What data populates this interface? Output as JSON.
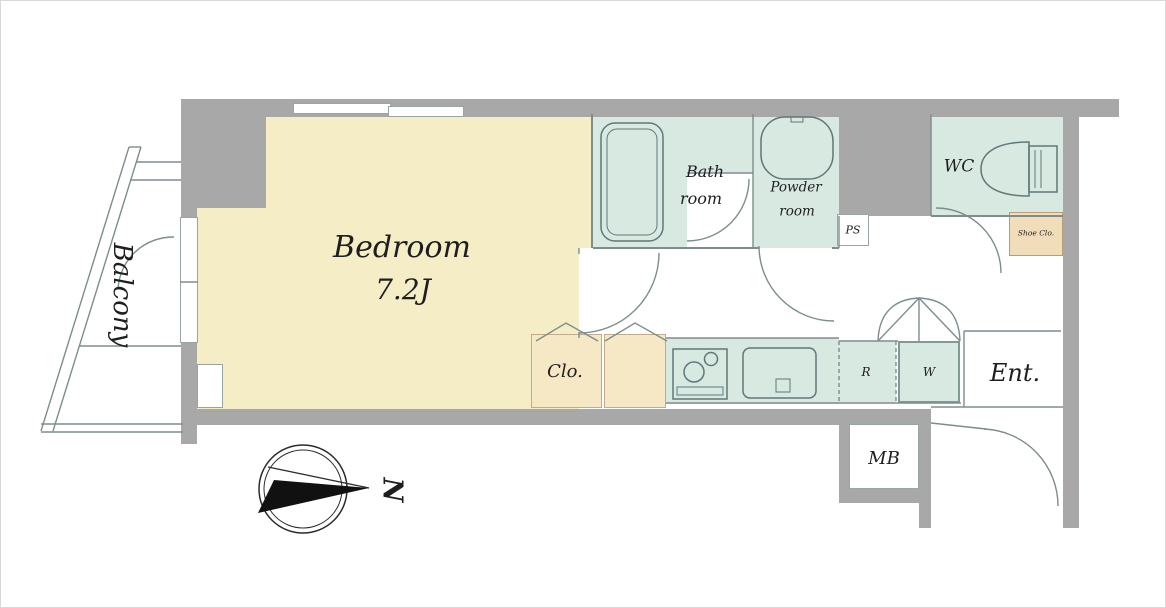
{
  "rooms": {
    "bedroom": {
      "label": "Bedroom",
      "size": "7.2J"
    },
    "balcony": {
      "label": "Balcony"
    },
    "bathroom": {
      "label_line1": "Bath",
      "label_line2": "room"
    },
    "powder_room": {
      "label_line1": "Powder",
      "label_line2": "room"
    },
    "wc": {
      "label": "WC"
    },
    "closet": {
      "label": "Clo."
    },
    "shoe_closet": {
      "label": "Shoe Clo."
    },
    "entrance": {
      "label": "Ent."
    },
    "meter_box": {
      "label": "MB"
    },
    "pipe_space": {
      "label": "PS"
    },
    "refrigerator_space": {
      "label": "R"
    },
    "washer_space": {
      "label": "W"
    }
  },
  "compass": {
    "north_label": "N"
  },
  "colors": {
    "bedroom_floor": "#f4edc6",
    "wet_area_floor": "#d8e9e2",
    "closet_floor": "#f6e7c5",
    "wall": "#a8a8a8",
    "line": "#7d8d8d"
  }
}
